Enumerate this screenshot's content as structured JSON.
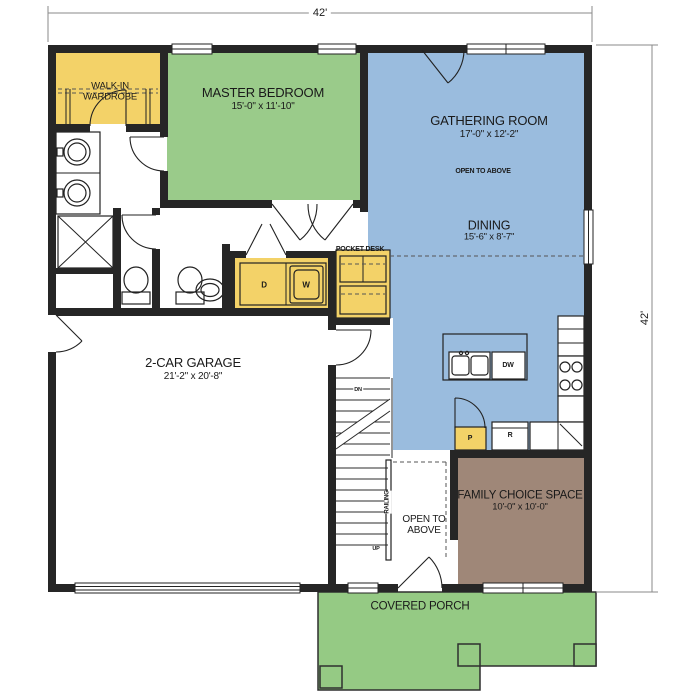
{
  "colors": {
    "wall": "#262626",
    "yellow": "#F3D268",
    "green": "#9ACB8A",
    "blue": "#9ABCDE",
    "brown": "#9F8778",
    "porch": "#95CA84",
    "text": "#1A1A1A"
  },
  "dimensions": {
    "width": "42'",
    "height": "42'"
  },
  "rooms": {
    "wardrobe": {
      "line1": "WALK-IN",
      "line2": "WARDROBE"
    },
    "master_bedroom": {
      "name": "MASTER BEDROOM",
      "dims": "15'-0\" x 11'-10\""
    },
    "gathering_room": {
      "name": "GATHERING ROOM",
      "dims": "17'-0\" x 12'-2\"",
      "note": "OPEN TO ABOVE"
    },
    "dining": {
      "name": "DINING",
      "dims": "15'-6\" x 8'-7\""
    },
    "garage": {
      "name": "2-CAR GARAGE",
      "dims": "21'-2\" x 20'-8\""
    },
    "family_choice": {
      "name": "FAMILY CHOICE SPACE",
      "dims": "10'-0\" x 10'-0\""
    },
    "covered_porch": {
      "name": "COVERED PORCH"
    },
    "stairwell": {
      "line1": "OPEN TO",
      "line2": "ABOVE"
    }
  },
  "labels": {
    "pocket_desk": "POCKET DESK",
    "railing": "RAILING",
    "down": "DN",
    "up": "UP",
    "dryer": "D",
    "washer": "W",
    "dishwasher": "DW",
    "pantry": "P",
    "refrigerator": "R"
  }
}
